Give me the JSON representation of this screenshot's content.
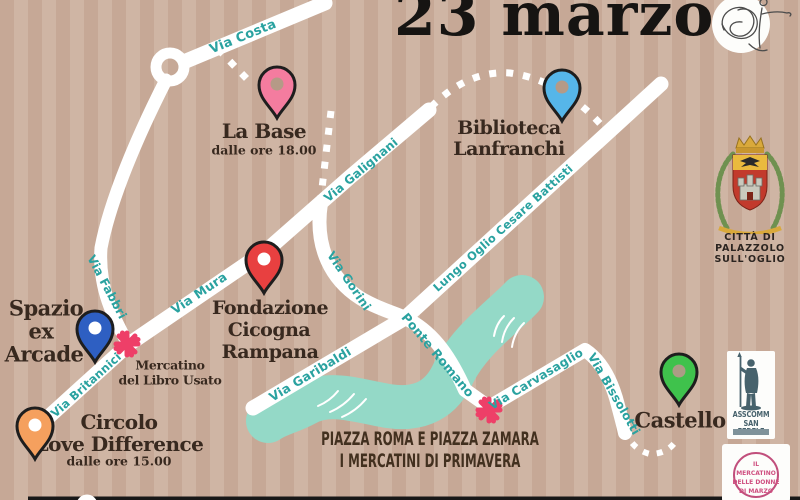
{
  "title": "23 marzo",
  "map": {
    "streets": {
      "costa": "Via Costa",
      "fabbri": "Via Fabbri",
      "mura": "Via Mura",
      "britannici": "Via Britannici",
      "galignani": "Via Galignani",
      "gorini": "Via Gorini",
      "lungo_oglio": "Lungo Oglio Cesare Battisti",
      "garibaldi": "Via Garibaldi",
      "ponte_romano": "Ponte Romano",
      "carvasaglio": "Via Carvasaglio",
      "bissolotti": "Via Bissolotti"
    },
    "venues": {
      "la_base": {
        "name": "La Base",
        "time": "dalle ore 18.00",
        "pin_color": "#f47c9f"
      },
      "biblioteca": {
        "line1": "Biblioteca",
        "line2": "Lanfranchi",
        "pin_color": "#56b6e9"
      },
      "fondazione": {
        "line1": "Fondazione",
        "line2": "Cicogna",
        "line3": "Rampana",
        "pin_color": "#e84040"
      },
      "spazio": {
        "line1": "Spazio",
        "line2": "ex",
        "line3": "Arcade",
        "pin_color": "#2e5fc2"
      },
      "circolo": {
        "line1": "Circolo",
        "line2": "Love Difference",
        "time": "dalle ore 15.00",
        "pin_color": "#f5a05e"
      },
      "castello": {
        "name": "Castello",
        "pin_color": "#3fc24c"
      }
    },
    "markets": {
      "libro_usato": {
        "line1": "Mercatino",
        "line2": "del Libro Usato"
      },
      "primavera": {
        "line1": "PIAZZA ROMA E PIAZZA ZAMARA",
        "line2": "I MERCATINI DI PRIMAVERA"
      }
    }
  },
  "badges": {
    "city_crest": {
      "line1": "CITTÀ DI",
      "line2": "PALAZZOLO",
      "line3": "SULL'OGLIO"
    },
    "asscomm": {
      "line1": "ASSCOMM",
      "line2": "SAN FEDELE"
    },
    "donne": {
      "line1": "IL",
      "line2": "MERCATINO",
      "line3": "DELLE DONNE",
      "line4": "DI MARZO"
    }
  },
  "colors": {
    "background_stripe_light": "#cfb5a4",
    "background_stripe_dark": "#c6a896",
    "road": "#ffffff",
    "river": "#94d9c7",
    "street_label": "#2aa2a0",
    "venue_label": "#38291f",
    "asterisk": "#ee3f68",
    "title": "#161412"
  }
}
